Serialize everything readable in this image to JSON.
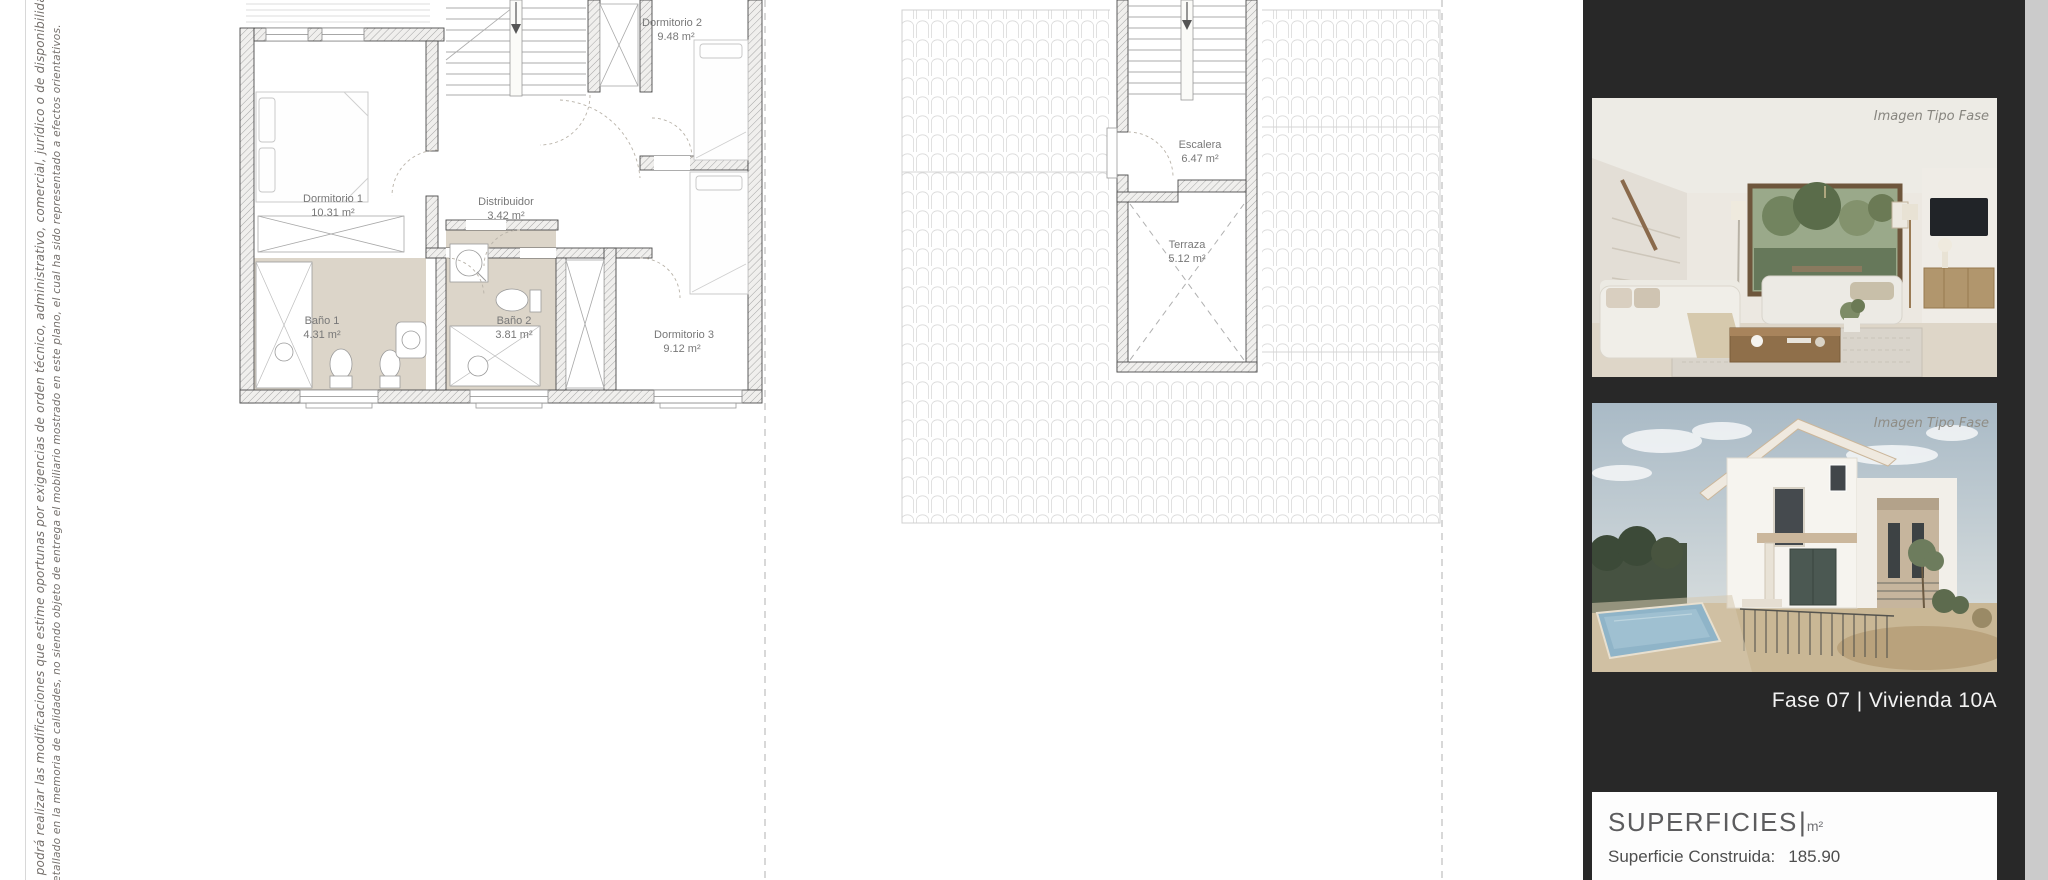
{
  "disclaimer": {
    "line1": "SL podrá realizar las modificaciones que estime oportunas por exigencias de orden técnico, administrativo, comercial, jurídico o de disponibilidad. Las superficie",
    "line2": "detallado en la memoria de calidades, no siendo objeto de entrega el mobiliario mostrado en este plano, el cual ha sido representado a efectos orientativos."
  },
  "plan_upper": {
    "rooms": [
      {
        "name": "Dormitorio 1",
        "area": "10.31 m²"
      },
      {
        "name": "Dormitorio 2",
        "area": "9.48 m²"
      },
      {
        "name": "Dormitorio 3",
        "area": "9.12 m²"
      },
      {
        "name": "Distribuidor",
        "area": "3.42 m²"
      },
      {
        "name": "Baño 1",
        "area": "4.31 m²"
      },
      {
        "name": "Baño 2",
        "area": "3.81 m²"
      }
    ]
  },
  "plan_roof": {
    "rooms": [
      {
        "name": "Escalera",
        "area": "6.47 m²"
      },
      {
        "name": "Terraza",
        "area": "5.12 m²"
      }
    ]
  },
  "sidebar": {
    "photo1": {
      "label": "Imagen Tipo Fase"
    },
    "photo2": {
      "label": "Imagen Tipo Fase"
    },
    "caption": "Fase 07 |  Vivienda 10A",
    "surfaces": {
      "title": "SUPERFICIES",
      "separator": "|",
      "unit": "m²",
      "construida_label": "Superficie Construida:",
      "construida_value": "185.90"
    }
  },
  "colors": {
    "sidebar_bg": "#282828",
    "page_edge": "#cbcbcb",
    "bathroom_floor": "#dcd5c9",
    "plan_wall_line": "#4a4a4a",
    "roof_tile_line": "#dadada",
    "label_text": "#787878"
  }
}
